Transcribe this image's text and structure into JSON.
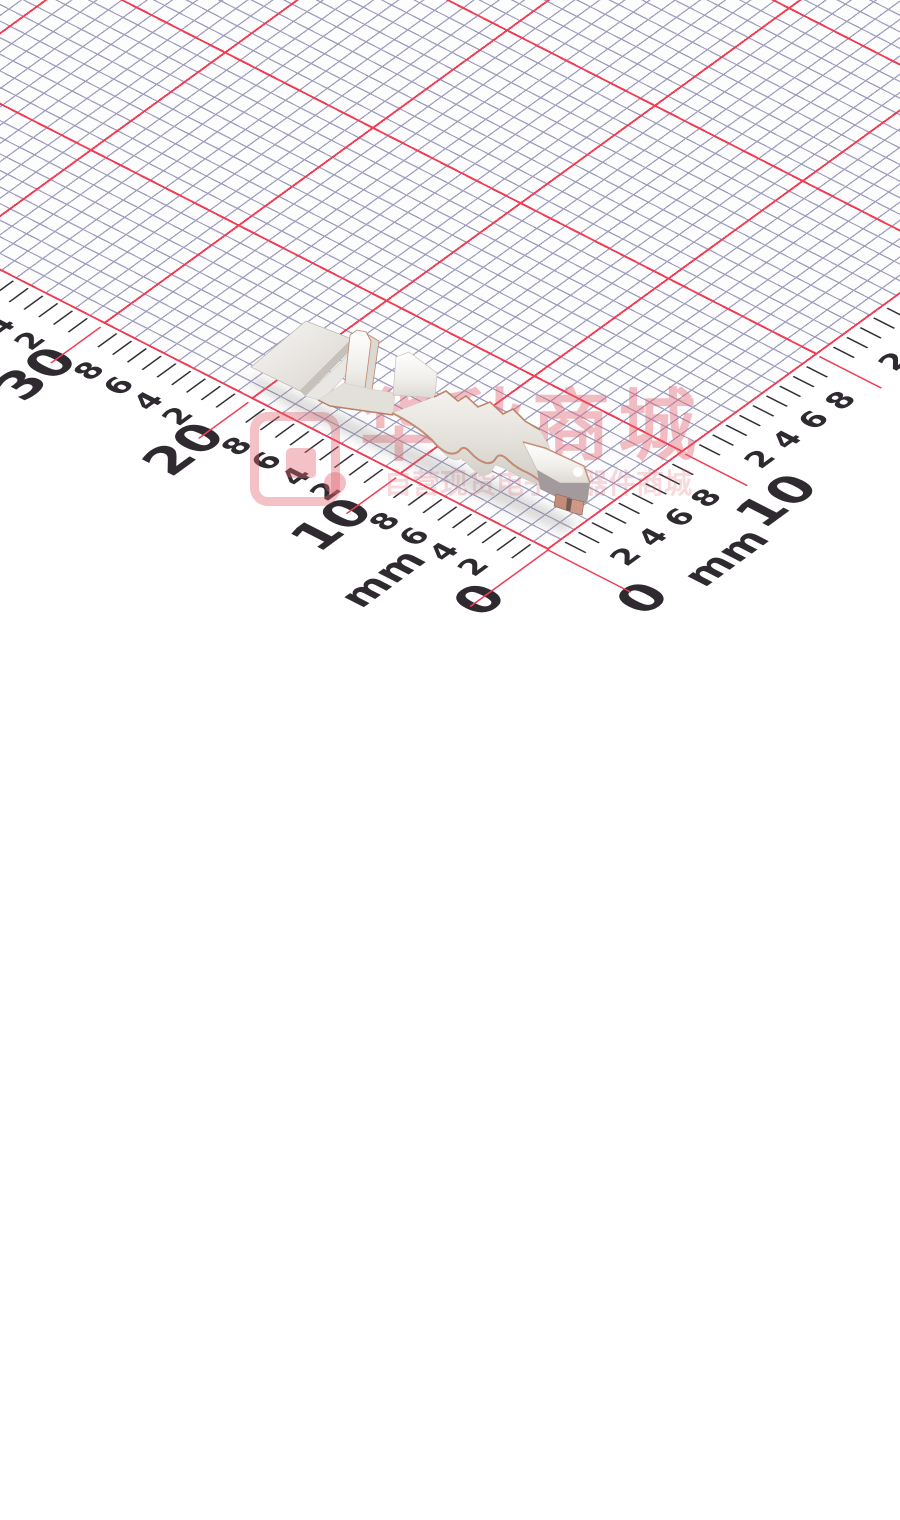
{
  "photo": {
    "background_color": "#ffffff"
  },
  "grid": {
    "fine_line_color": "#9e9ec0",
    "major_line_color": "#f23c54",
    "cell_mm": 1,
    "major_every_mm": 10
  },
  "ruler": {
    "unit_label": "mm",
    "text_color": "#2e2a30",
    "left_axis": {
      "major_labels": [
        "0",
        "10",
        "20",
        "30"
      ],
      "minor_labels": [
        "2",
        "4",
        "6",
        "8"
      ],
      "minor_max_mm": 35,
      "tick_max_mm": 39
    },
    "right_axis": {
      "major_labels": [
        "0",
        "10"
      ],
      "minor_labels": [
        "2",
        "4",
        "6",
        "8"
      ],
      "minor_max_mm": 25,
      "tick_max_mm": 26
    }
  },
  "watermark": {
    "brand_text": "华秋商城",
    "tagline_text": "自营现货电子元器件商城",
    "accent_color": "#e2646e",
    "logo": "huaqiu-speech-bubble-exclamation"
  },
  "component": {
    "description_label": "metal crimp terminal"
  }
}
